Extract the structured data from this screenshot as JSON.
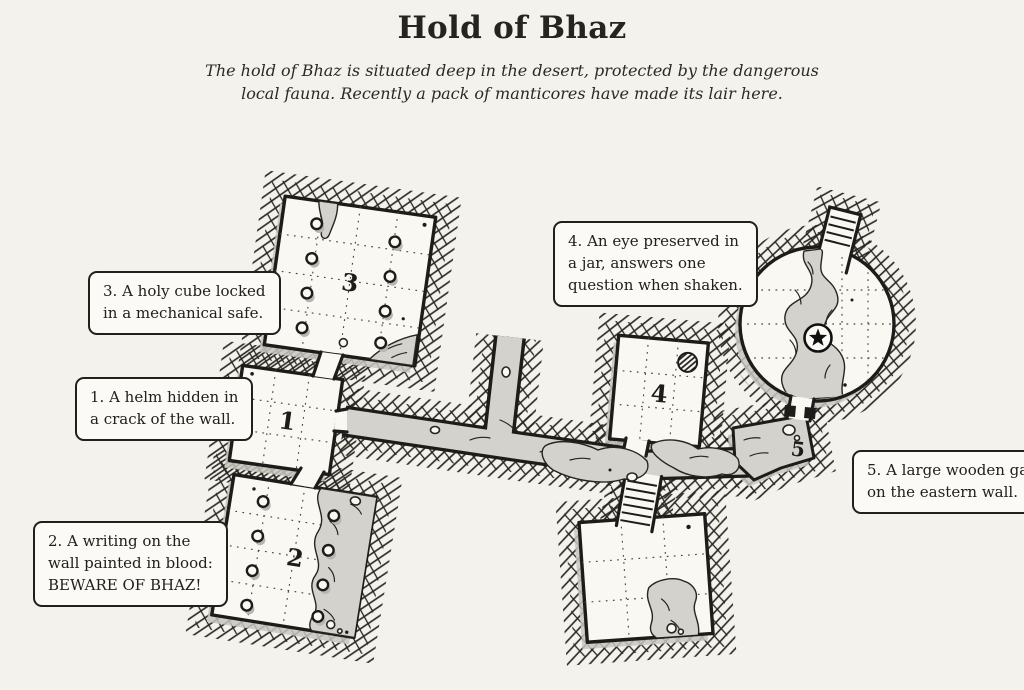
{
  "header": {
    "title": "Hold of Bhaz",
    "subtitle_lines": [
      "The hold of Bhaz is situated deep in the desert, protected by the dangerous",
      "local fauna. Recently a pack of manticores have made its lair here."
    ]
  },
  "map": {
    "room_labels": [
      "1",
      "2",
      "3",
      "4",
      "5"
    ],
    "notes": [
      {
        "room": "1",
        "lines": [
          "1. A helm hidden in",
          "a crack of the wall."
        ]
      },
      {
        "room": "2",
        "lines": [
          "2. A writing on the",
          "wall painted in blood:",
          "BEWARE OF BHAZ!"
        ]
      },
      {
        "room": "3",
        "lines": [
          "3. A holy cube locked",
          "in a mechanical safe."
        ]
      },
      {
        "room": "4",
        "lines": [
          "4. An eye preserved in",
          "a jar, answers one",
          "question when shaken."
        ]
      },
      {
        "room": "5",
        "lines": [
          "5. A large wooden gate",
          "on the eastern wall."
        ]
      }
    ],
    "icons": {
      "star_emblem": "point-of-interest-star",
      "hatched_disc": "object-marker",
      "column_circles": "pillars",
      "lined_strips": "stairs",
      "black_bars": "double-door"
    }
  },
  "colors": {
    "background": "#f3f2ec",
    "ink": "#1d1c1a",
    "room_fill": "#f9f8f3",
    "cave_fill": "#d3d2cc",
    "shadow": "#c8c7c0"
  }
}
